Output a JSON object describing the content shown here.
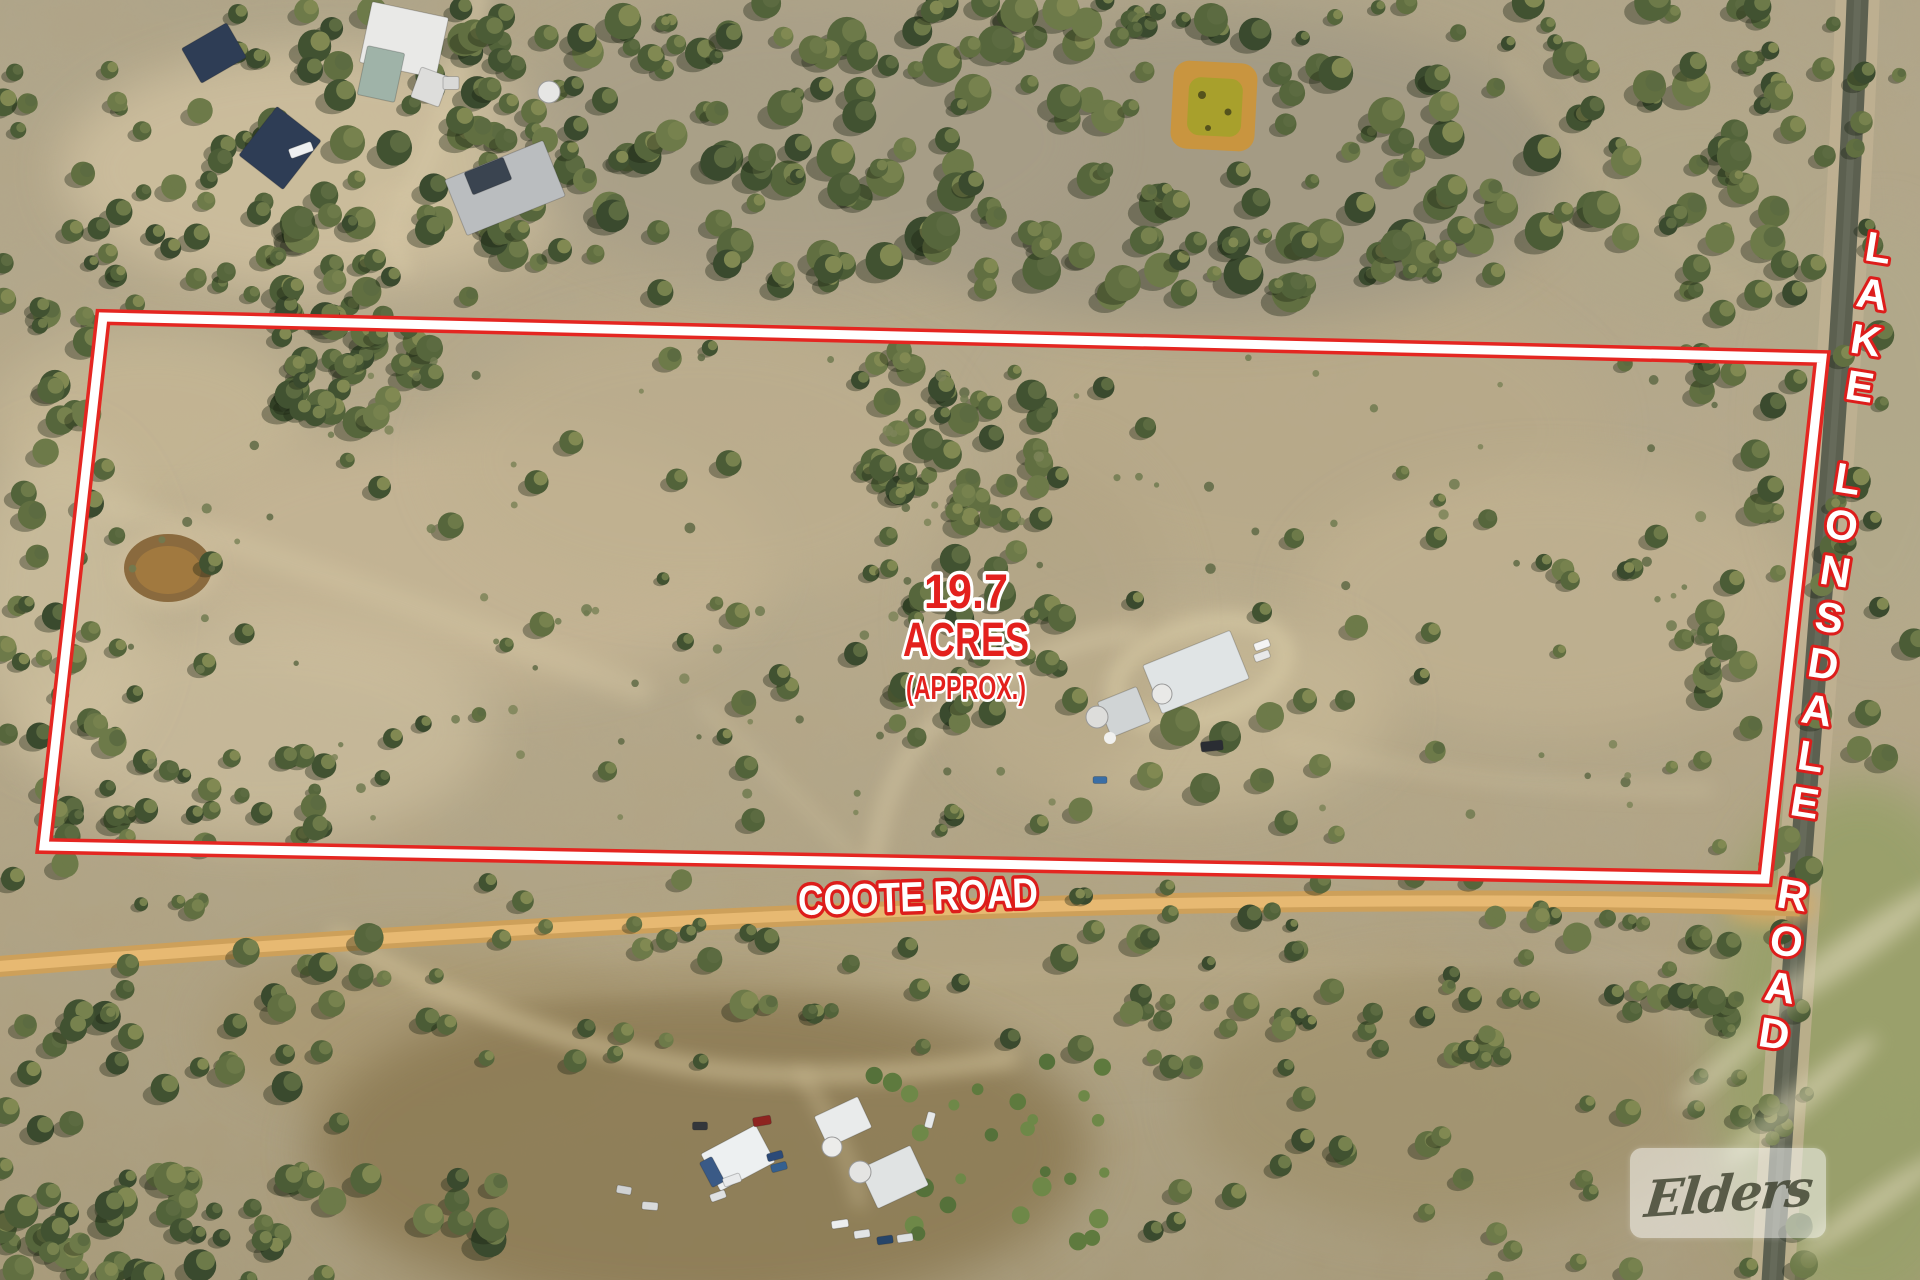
{
  "annotations": {
    "area_value": "19.7",
    "area_unit": "ACRES",
    "area_approx": "(APPROX.)",
    "road_label_horizontal": "COOTE ROAD",
    "road_label_vertical": "LAKE LONSDALE ROAD",
    "boundary_color": "#e42621",
    "label_red": "#e3201d",
    "label_white": "#ffffff"
  },
  "watermark": {
    "brand": "Elders"
  }
}
